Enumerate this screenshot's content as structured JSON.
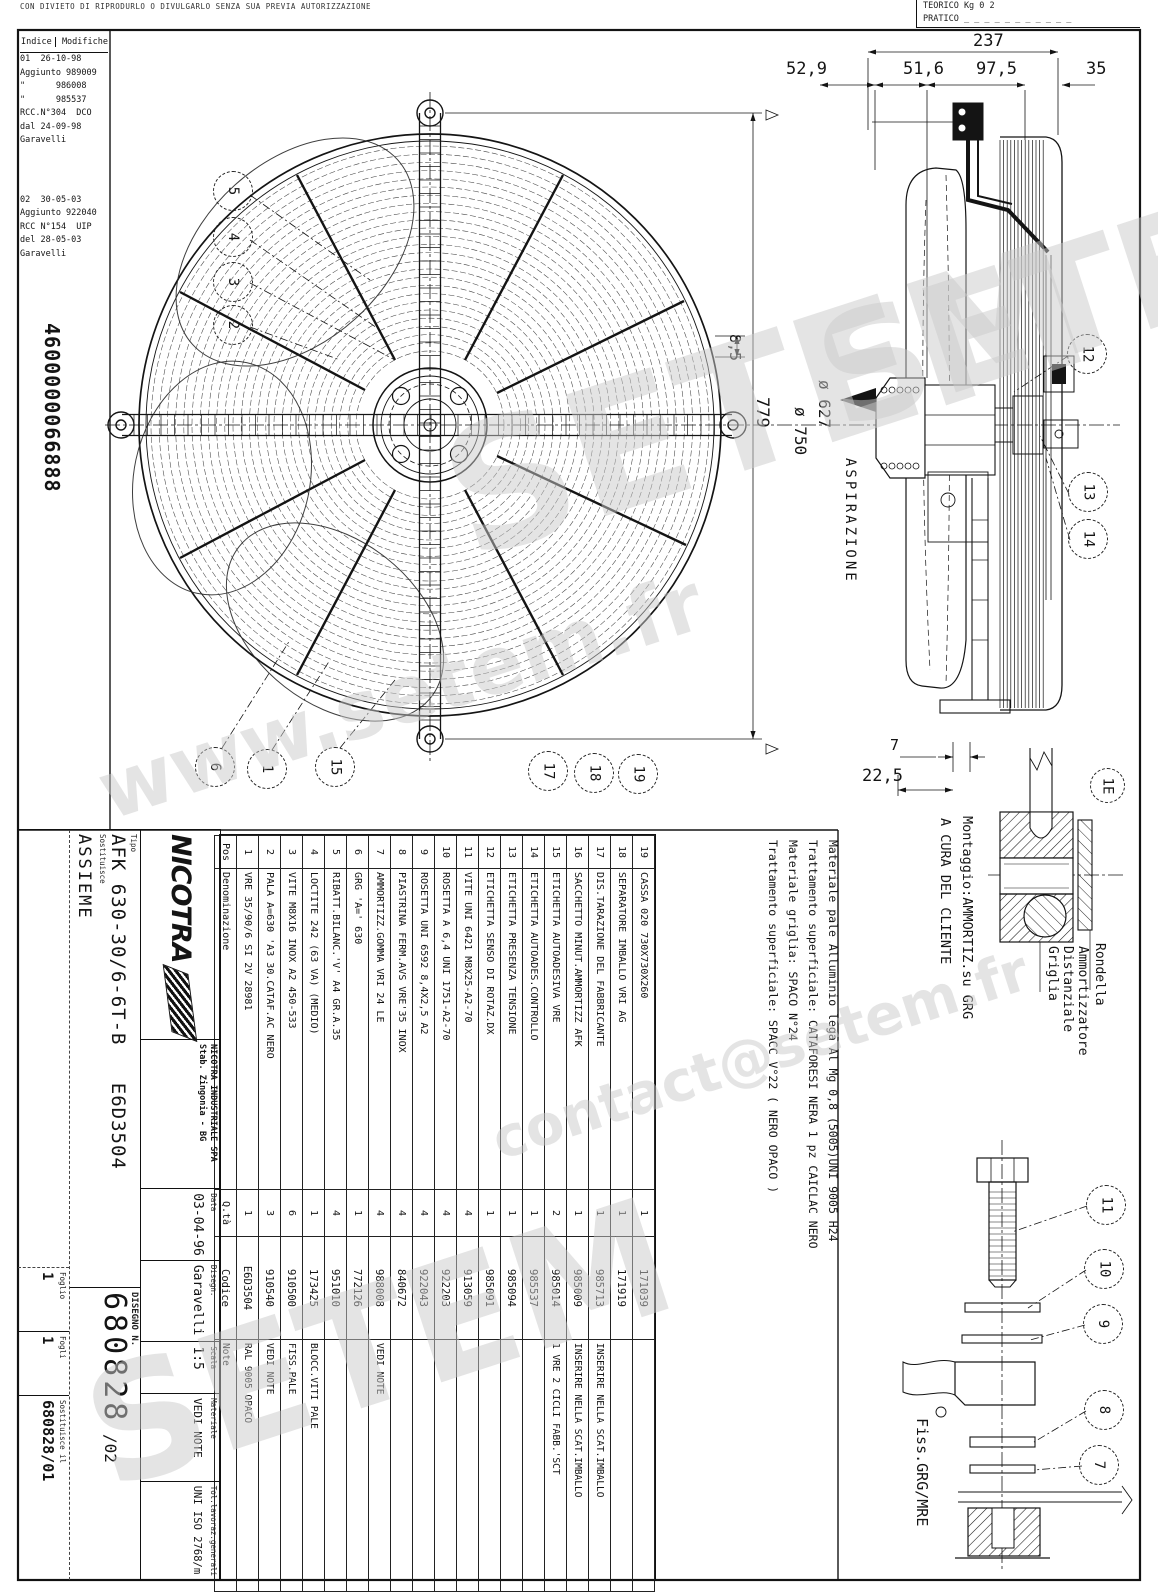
{
  "page": {
    "top_note": "CON DIVIETO DI RIPRODURLO O DIVULGARLO SENZA SUA PREVIA AUTORIZZAZIONE",
    "part_number": "4600000066888"
  },
  "weight_box": {
    "line1": "TEORICO Kg   0 2",
    "line2": "PRATICO _ _ _ _ _ _ _ _ _ _ _"
  },
  "revisions": {
    "header_left": "Indice",
    "header_right": "Modifiche",
    "lines": [
      "01  26-10-98",
      "Aggiunto 989009",
      "\"      986008",
      "\"      985537",
      "RCC.N°304  DCO",
      "dal 24-09-98",
      "Garavelli",
      "",
      "02  30-05-03",
      "Aggiunto 922040",
      "RCC N°154  UIP",
      "del 28-05-03",
      "Garavelli"
    ]
  },
  "balloons": {
    "n1": "1",
    "n2": "2",
    "n3": "3",
    "n4": "4",
    "n5": "5",
    "n6": "6",
    "n7": "7",
    "n8": "8",
    "n9": "9",
    "n10": "10",
    "n11": "11",
    "n12": "12",
    "n13": "13",
    "n14": "14",
    "n15": "15",
    "n17": "17",
    "n18": "18",
    "n19": "19",
    "detail_ref": "1E"
  },
  "dims": {
    "front_gap": "8,5",
    "front_height": "779",
    "dia_627": "ø 627",
    "dia_750": "ø 750",
    "depth_237": "237",
    "d_529": "52,9",
    "d_516": "51,6",
    "d_975": "97,5",
    "d_35": "35",
    "d_7": "7",
    "d_225": "22,5"
  },
  "annotations": {
    "aspirazione": "ASPIRAZIONE",
    "montaggio": "Montaggio:AMMORTIZ.su GRG",
    "a_cura": "A CURA DEL CLIENTE",
    "griglia": "Griglia",
    "distanziale": "Distanziale",
    "ammortizzatore": "Ammortizzatore",
    "rondella": "Rondella",
    "fiss": "Fiss.GRG/MRE"
  },
  "material_notes": [
    "Materiale pale Alluminio lega Al Mg 0,8 (5005)UNI 9005 H24",
    "Trattamento superficiale: CATAFORESI NERA 1 pz CAICLAC NERO",
    "Materiale griglia: SPACO N°24",
    "Trattamento superficiale: SPACC V°22 ( NERO OPACO )"
  ],
  "parts_table": {
    "headers": {
      "pos": "Pos",
      "den": "Denominazione",
      "qty": "Q.tà",
      "code": "Codice",
      "note": "Note"
    },
    "rows": [
      {
        "pos": "1",
        "den": "VRE 35/90/6 SI 2V 28981",
        "qty": "1",
        "code": "E6D3504",
        "note": "RAL 9005 OPACO"
      },
      {
        "pos": "2",
        "den": "PALA A=630 'A3 30.CATAF.AC NERO",
        "qty": "3",
        "code": "910540",
        "note": "VEDI NOTE"
      },
      {
        "pos": "3",
        "den": "VITE M8X16 INOX A2 450-533",
        "qty": "6",
        "code": "910500",
        "note": "FISS.PALE"
      },
      {
        "pos": "4",
        "den": "LOCTITE 242 (63 VA) (MEDIO)",
        "qty": "1",
        "code": "173425",
        "note": "BLOCC.VITI PALE"
      },
      {
        "pos": "5",
        "den": "RIBATT.BILANC.'V' A4 GR.A.35",
        "qty": "4",
        "code": "951010",
        "note": ""
      },
      {
        "pos": "6",
        "den": "GRG 'A=' 630",
        "qty": "1",
        "code": "772126",
        "note": ""
      },
      {
        "pos": "7",
        "den": "AMMORTIZZ.GOMMA VRI 24 LE",
        "qty": "4",
        "code": "988008",
        "note": "VEDI NOTE"
      },
      {
        "pos": "8",
        "den": "PIASTRINA FERM.AVS VRE'35 INOX",
        "qty": "4",
        "code": "840672",
        "note": ""
      },
      {
        "pos": "9",
        "den": "ROSETTA UNI 6592 8,4X2,5 A2",
        "qty": "4",
        "code": "922043",
        "note": ""
      },
      {
        "pos": "10",
        "den": "ROSETTA A 6,4 UNI 1751-A2-70",
        "qty": "4",
        "code": "922203",
        "note": ""
      },
      {
        "pos": "11",
        "den": "VITE UNI 6421 M8X25-A2-70",
        "qty": "4",
        "code": "913059",
        "note": ""
      },
      {
        "pos": "12",
        "den": "ETICHETTA SENSO DI ROTAZ.DX",
        "qty": "1",
        "code": "985091",
        "note": ""
      },
      {
        "pos": "13",
        "den": "ETICHETTA PRESENZA TENSIONE",
        "qty": "1",
        "code": "985094",
        "note": ""
      },
      {
        "pos": "14",
        "den": "ETICHETTA AUTOADES.CONTROLLO",
        "qty": "1",
        "code": "985537",
        "note": ""
      },
      {
        "pos": "15",
        "den": "ETICHETTA AUTOADESIVA VRE",
        "qty": "2",
        "code": "985014",
        "note": "1 VRE 2 CICLI FABB.'SCT"
      },
      {
        "pos": "16",
        "den": "SACCHETTO MINUT.AMMORTIZZ AFK",
        "qty": "1",
        "code": "985009",
        "note": "INSERIRE NELLA SCAT.IMBALLO"
      },
      {
        "pos": "17",
        "den": "DIS.TARAZIONE DEL FABBRICANTE",
        "qty": "1",
        "code": "985713",
        "note": "INSERIRE NELLA SCAT.IMBALLO"
      },
      {
        "pos": "18",
        "den": "SEPARATORE IMBALLO VRI AG",
        "qty": "1",
        "code": "171919",
        "note": ""
      },
      {
        "pos": "19",
        "den": "CASSA 020 730X730X260",
        "qty": "1",
        "code": "171039",
        "note": ""
      }
    ]
  },
  "title_block": {
    "logo": "NICOTRA",
    "company_line1": "NICOTRA INDUSTRIALE SPA",
    "company_line2": "Stab. Zingonia - BG",
    "labels": {
      "tipo": "Tipo",
      "sostituisce": "Sostituisce",
      "data": "Data",
      "disegn": "Disegn.",
      "scala": "Scala",
      "materiale": "Materiale",
      "tolleranze": "Tol.lavoraz.generali",
      "disegno_n": "DISEGNO N.",
      "foglio": "Foglio",
      "fogli": "Fogli",
      "sost_il": "Sostituisce il"
    },
    "values": {
      "tipo": "AFK 630-30/6-6T-B",
      "codice": "E6D3504",
      "descrizione": "ASSIEME",
      "data": "03-04-96",
      "disegnatore": "Garavelli",
      "scala": "1:5",
      "materiale": "VEDI NOTE",
      "tolleranze": "UNI ISO 2768/m",
      "disegno_n": "680828",
      "revisione": "/02",
      "foglio": "1",
      "fogli": "1",
      "sostituisce_il": "680828/01"
    }
  },
  "watermarks": {
    "w1": "SETEM",
    "w2": "www.setem.fr",
    "w3": "SETEM",
    "w4": "contact@setem.fr",
    "w5": "SETEM"
  }
}
